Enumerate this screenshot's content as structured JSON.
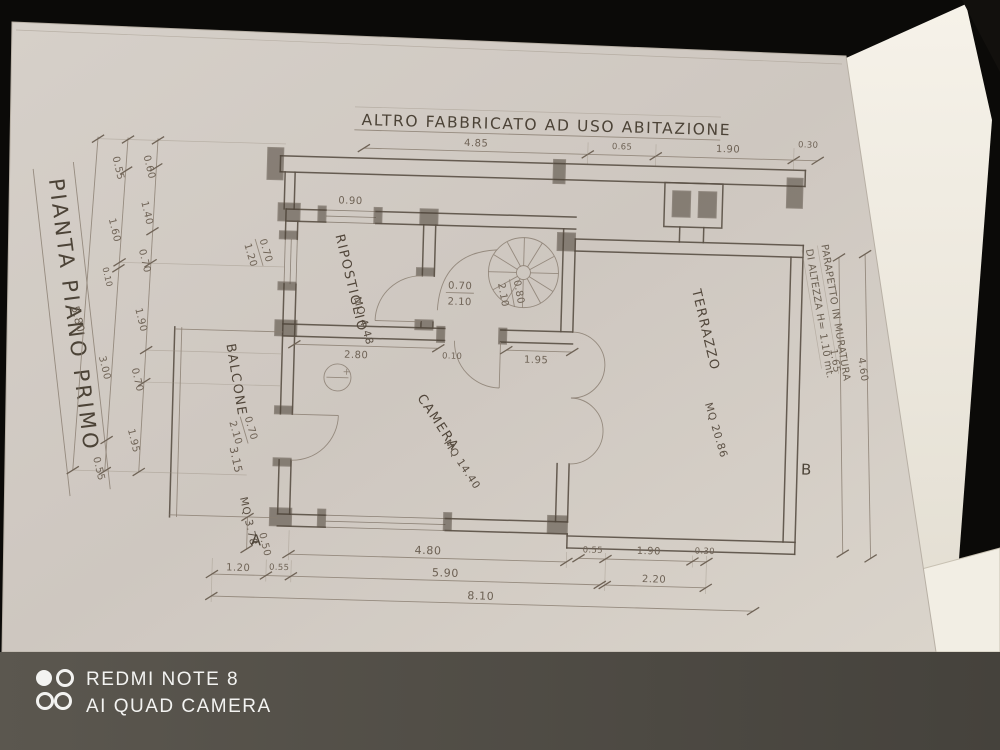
{
  "watermark": {
    "device": "REDMI NOTE 8",
    "camera": "AI QUAD CAMERA"
  },
  "titles": {
    "side": "PIANTA PIANO PRIMO",
    "top_building": "ALTRO FABBRICATO AD USO ABITAZIONE"
  },
  "notes": {
    "parapet_1": "PARAPETTO IN MURATURA",
    "parapet_2": "DI ALTEZZA H= 1.10 mt."
  },
  "rooms": {
    "ripostiglio": {
      "name": "RIPOSTIGLIO",
      "area": "MQ 4.48"
    },
    "camera": {
      "name": "CAMERA",
      "area": "MQ 14.40"
    },
    "terrazzo": {
      "name": "TERRAZZO",
      "area": "MQ 20.86"
    },
    "balcone": {
      "name": "BALCONE",
      "length": "3.15",
      "area": "MQ 3.78"
    }
  },
  "markers": {
    "a": "A",
    "b": "B"
  },
  "dims": {
    "top": [
      "4.85",
      "0.65",
      "1.90",
      "0.30"
    ],
    "left_inner": [
      "0.60",
      "1.40",
      "0.70",
      "1.90",
      "0.70",
      "1.95"
    ],
    "left_mid": [
      "0.55",
      "1.60",
      "0.10",
      "3.00",
      "0.55"
    ],
    "left_outer": "5.80",
    "step": "0.50",
    "south_inner": "4.80",
    "south_right": [
      "0.55",
      "1.90",
      "0.30",
      "2.20"
    ],
    "south_mid": [
      "1.20",
      "0.55",
      "5.90"
    ],
    "south_outer": "8.10",
    "interior": {
      "window_n": "0.90",
      "seg_a": "2.80",
      "seg_b": "0.10",
      "seg_c": "1.95"
    },
    "right_side": [
      "1.65",
      "4.60"
    ],
    "openings": {
      "window_w": [
        "0.70",
        "1.20"
      ],
      "door_balcone": [
        "0.70",
        "2.10"
      ],
      "door_ripostiglio": [
        "0.70",
        "2.10"
      ],
      "door_stair": [
        "0.80",
        "2.10"
      ]
    }
  }
}
